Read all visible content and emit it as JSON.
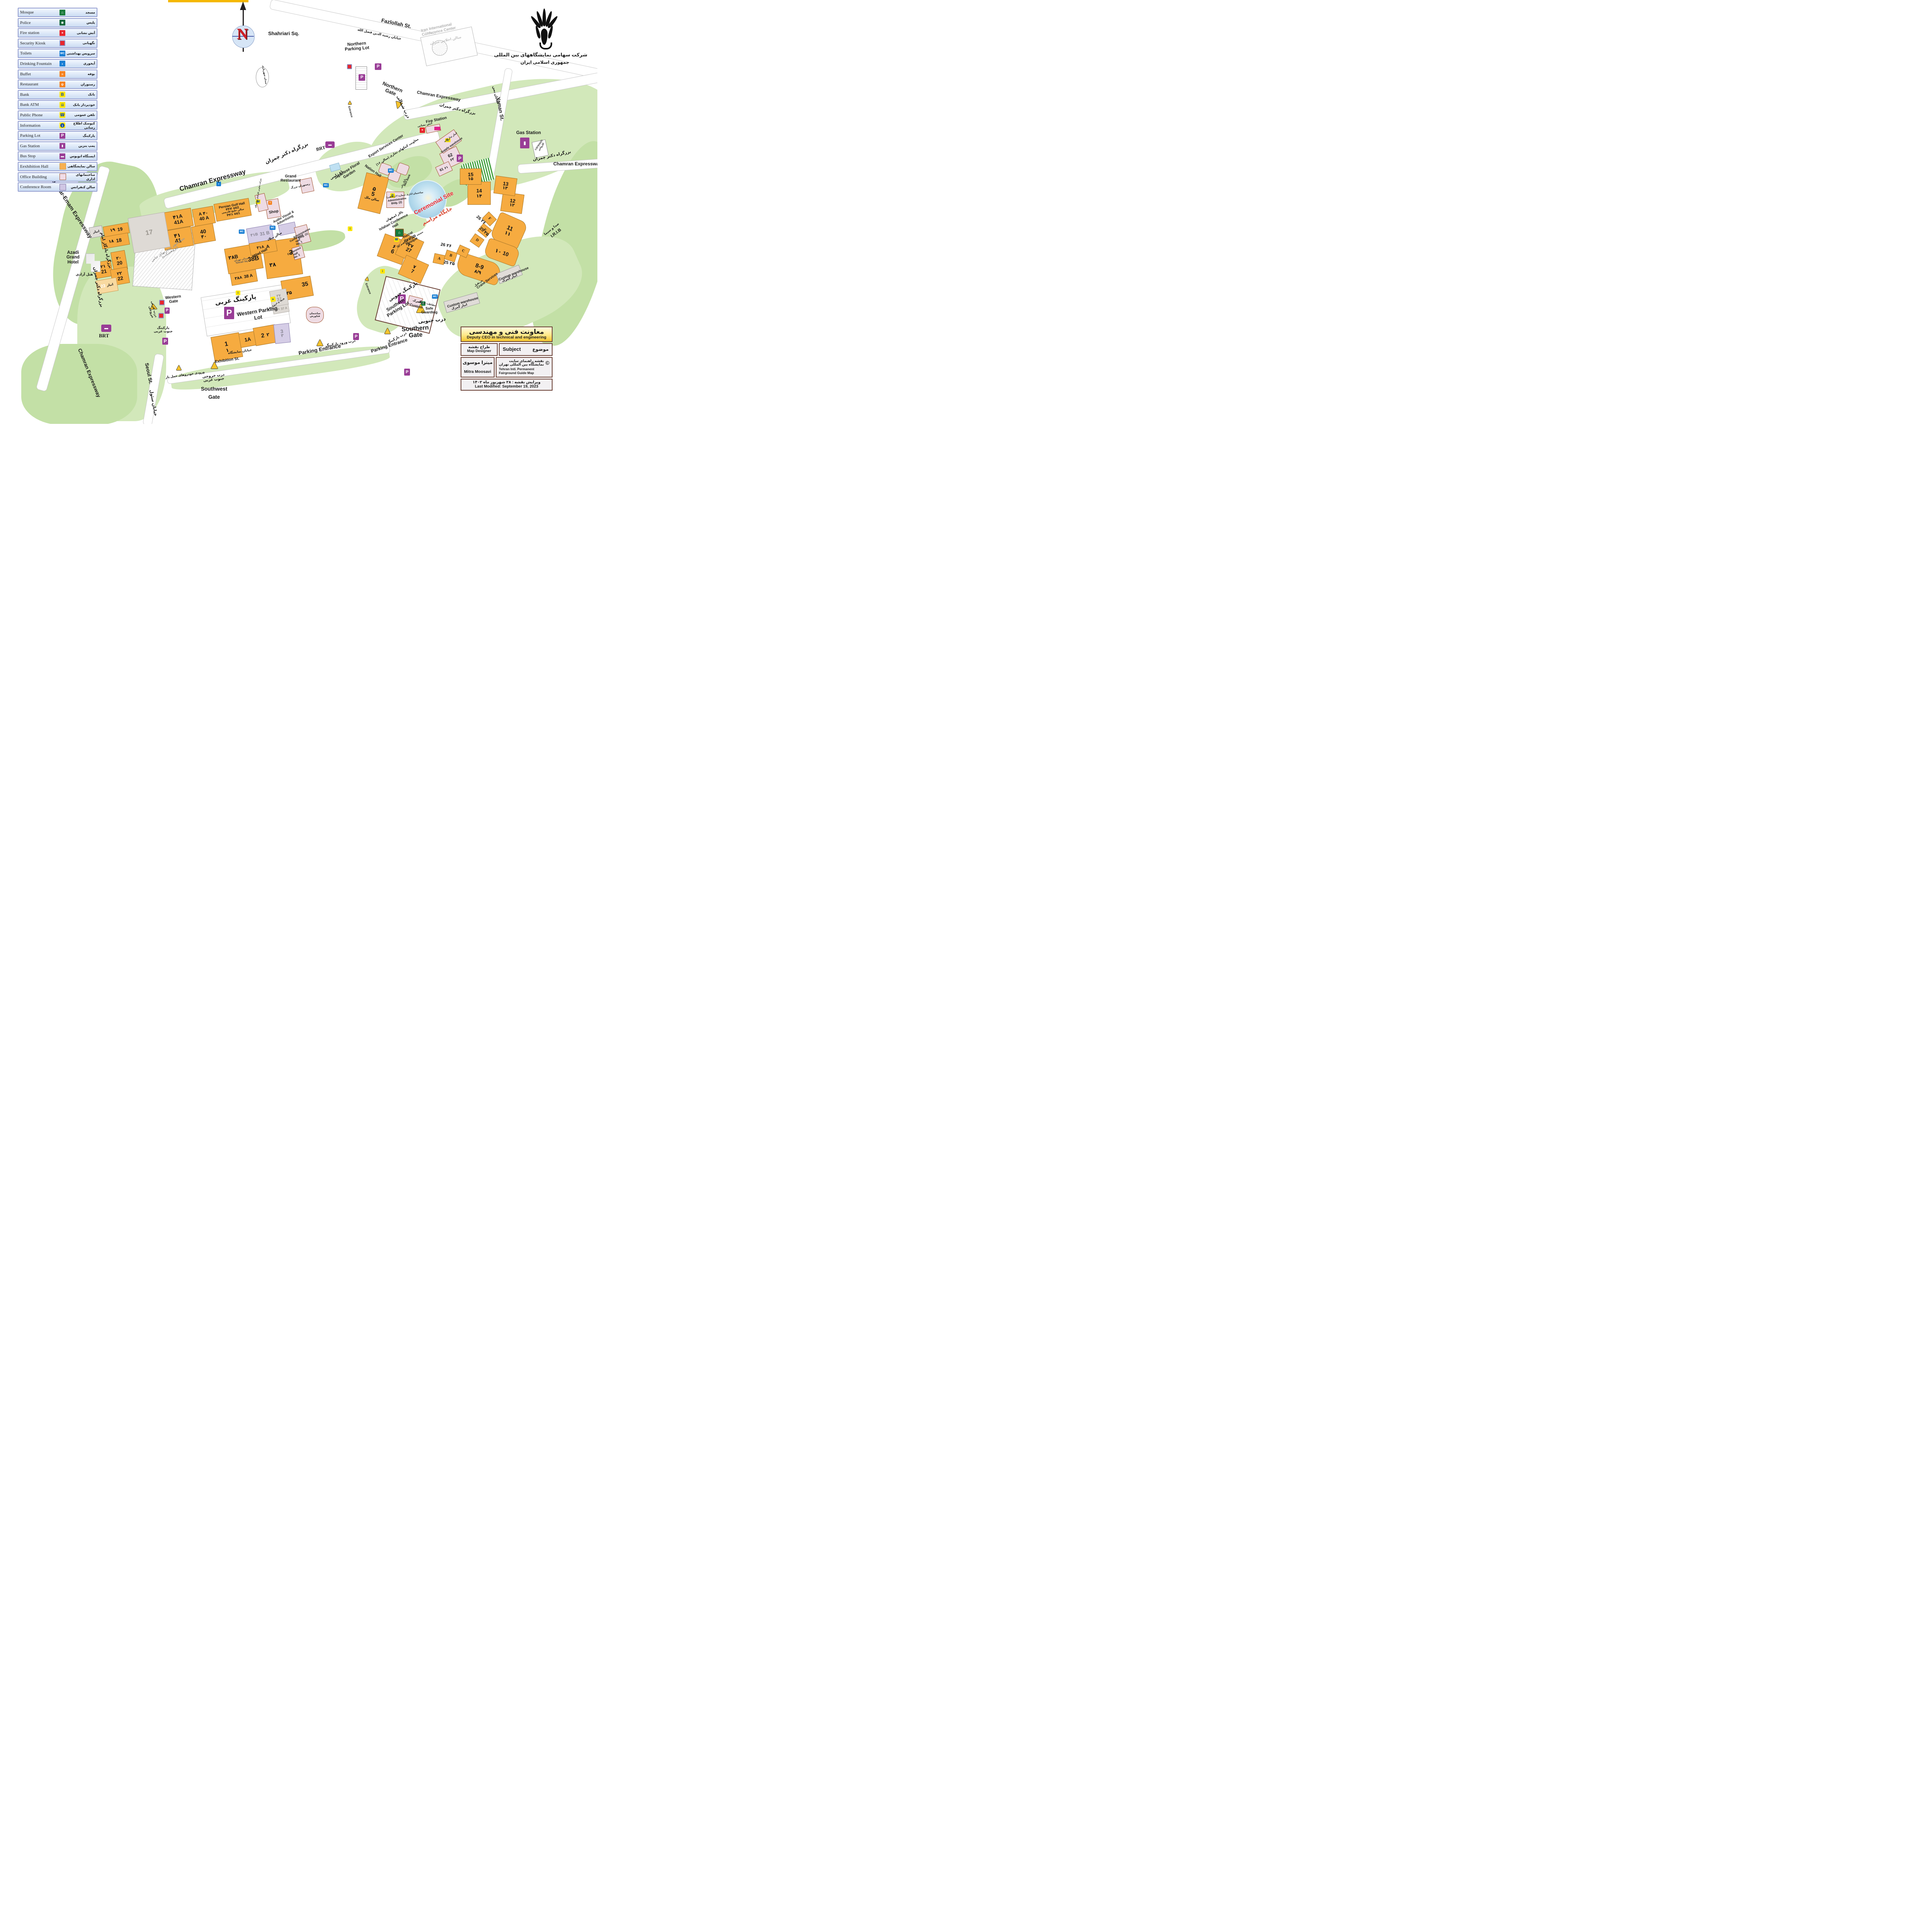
{
  "brand": {
    "company_fa_line1": "شرکت سهامی نمایشگاههای بین المللی",
    "company_fa_line2": "جمهوری اسلامی ایران",
    "compass_n": "N"
  },
  "legend": {
    "items": [
      {
        "en": "Mosque",
        "fa": "مسجد",
        "glyph": "⌂"
      },
      {
        "en": "Police",
        "fa": "پلیس",
        "glyph": "◉"
      },
      {
        "en": "Fire station",
        "fa": "آتش نشانی",
        "glyph": "✶"
      },
      {
        "en": "Security Kiosk",
        "fa": "نگهبانی",
        "glyph": ""
      },
      {
        "en": "Toilets",
        "fa": "سرویس بهداشتی",
        "glyph": "WC"
      },
      {
        "en": "Drinking Fountain",
        "fa": "آبخوری",
        "glyph": "◗"
      },
      {
        "en": "Buffet",
        "fa": "بوفه",
        "glyph": "≡"
      },
      {
        "en": "Restaurant",
        "fa": "رستوران",
        "glyph": "ψ"
      },
      {
        "en": "Bank",
        "fa": "بانک",
        "glyph": "B"
      },
      {
        "en": "Bank ATM",
        "fa": "خودپرداز بانک",
        "glyph": "▤"
      },
      {
        "en": "Public Phone",
        "fa": "تلفن عمومی",
        "glyph": "☎"
      },
      {
        "en": "Information",
        "fa": "کیوسک اطلاع رسانی",
        "glyph": "i"
      },
      {
        "en": "Parking Lot",
        "fa": "پارکینگ",
        "glyph": "P"
      },
      {
        "en": "Gas Station",
        "fa": "پمپ بنزین",
        "glyph": "▮"
      },
      {
        "en": "Bus Stop",
        "fa": "ایستگاه اتوبوس",
        "glyph": "▬"
      },
      {
        "en": "Eexhibition Hall",
        "fa": "سالن نمایشگاهی",
        "glyph": ""
      },
      {
        "en": "Office Building",
        "fa": "ساختمانهای اداری",
        "glyph": ""
      },
      {
        "en": "Conference Room",
        "fa": "سالن کنفرانس",
        "glyph": ""
      }
    ]
  },
  "top": {
    "shahriari": {
      "en": "Shahriari Sq.",
      "fa": "میدان شهریاری"
    },
    "conf_center": {
      "en1": "Iran International",
      "en2": "Conference Center",
      "fa": "سالن اجلاس سران"
    },
    "northern_parking1": "Northern",
    "northern_parking2": "Parking Lot"
  },
  "roads": {
    "chamran": {
      "en": "Chamran Expressway",
      "fa": "بزرگراه دکتر چمران"
    },
    "yadegar": {
      "en": "Yadegar-Emam Expressway",
      "fa": "بزرگراه یادگار امام"
    },
    "seoul": {
      "en": "Seoul St.",
      "fa": "خیابان سئول"
    },
    "yaman": {
      "en": "Yaman St.",
      "fa": "خیابان یمن"
    },
    "exhibition": {
      "en": "Exhibition St.",
      "fa": "خیابان نمایشگاه"
    },
    "fazlollah": {
      "en": "Fazlollah St.",
      "fa": "خیابان رشید الدین فضل الله"
    },
    "irib": {
      "en": "I.R.I.B",
      "fa": "صدا و سیما"
    },
    "brt": "BRT"
  },
  "gates": {
    "northern": {
      "en1": "Northern",
      "en2": "Gate",
      "fa": "درب شمالی"
    },
    "southern": {
      "en1": "Southern",
      "en2": "Gate",
      "fa": "درب جنوبی"
    },
    "western": {
      "en1": "Western",
      "en2": "Gate",
      "fa1": "درب غربی",
      "fa2": "خروجی"
    },
    "southwest": {
      "en1": "Southwest",
      "en2": "Gate",
      "fa1": "درب خروجی",
      "fa2": "جنوب غربی"
    },
    "pe_south": {
      "en": "Parking Entrance",
      "fa": "درب پارکینگ"
    },
    "pe_west": {
      "en": "Parking Entrance",
      "fa": "درب ورود پارکینگ"
    },
    "cargo": {
      "fa": "ورودی خودروهای حمل بار"
    },
    "entrance": {
      "en": "Entrance"
    }
  },
  "parking": {
    "western": {
      "en": "Western Parking Lot",
      "fa": "پارکینگ غربی"
    },
    "southern": {
      "en1": "Southern",
      "en2": "Parking Lot",
      "fa": "پارکینگ جنوبی"
    },
    "sw": {
      "fa1": "پارکینگ",
      "fa2": "جنوب غربی"
    }
  },
  "halls": [
    {
      "en": "41A",
      "fa": "۴۱A"
    },
    {
      "en": "41",
      "fa": "۴۱"
    },
    {
      "en": "40 A",
      "fa": "۴۰ A"
    },
    {
      "en": "40",
      "fa": "۴۰"
    },
    {
      "en": "19",
      "fa": "۱۹"
    },
    {
      "en": "18",
      "fa": "۱۸"
    },
    {
      "en": "17",
      "fa": ""
    },
    {
      "en": "20",
      "fa": "۲۰"
    },
    {
      "en": "21",
      "fa": "۲۱"
    },
    {
      "en": "22",
      "fa": "۲۲"
    },
    {
      "en": "23",
      "fa": "انبار"
    },
    {
      "en": "38B",
      "fa": "۳۸B"
    },
    {
      "en": "38 A",
      "fa": "۳۸A"
    },
    {
      "en": "38",
      "fa": "۳۸"
    },
    {
      "en": "35",
      "fa": "۳۵"
    },
    {
      "en": "37",
      "fa": "۳۷"
    },
    {
      "en": "37 A",
      "fa": "۳۷A"
    },
    {
      "en": "1",
      "fa": "۱"
    },
    {
      "en": "1A",
      "fa": ""
    },
    {
      "en": "2",
      "fa": "۲"
    },
    {
      "en": "3",
      "fa": "۳"
    },
    {
      "en": "5",
      "fa": "۵"
    },
    {
      "en": "6",
      "fa": "۶"
    },
    {
      "en": "27",
      "fa": "۲۷"
    },
    {
      "en": "7",
      "fa": "۷"
    },
    {
      "en": "8-9",
      "fa": "۸/۹"
    },
    {
      "en": "10",
      "fa": "۱۰"
    },
    {
      "en": "11",
      "fa": "۱۱"
    },
    {
      "en": "12",
      "fa": "۱۲"
    },
    {
      "en": "13",
      "fa": "۱۳"
    },
    {
      "en": "14",
      "fa": "۱۴"
    },
    {
      "en": "15",
      "fa": "۱۵"
    },
    {
      "en": "62",
      "fa": "۶۲"
    },
    {
      "en": "61",
      "fa": "۶۱"
    },
    {
      "en": "A"
    },
    {
      "en": "B"
    },
    {
      "en": "C"
    },
    {
      "en": "D"
    },
    {
      "en": "E"
    },
    {
      "en": "F"
    },
    {
      "en": "31 B",
      "fa": "۳۱B"
    },
    {
      "en": "A",
      "fa": "۳۱A"
    },
    {
      "en": "44/2",
      "fa": "۴۴/۲"
    },
    {
      "en": "44/1",
      "fa": "۴۴/۱"
    }
  ],
  "arc_labels": {
    "l25": {
      "en": "25",
      "fa": "۲۵"
    },
    "l26": {
      "en": "26",
      "fa": "۲۶"
    }
  },
  "facilities": {
    "persian_gulf": {
      "en1": "Persian Gulf",
      "en2": "Hall",
      "fa": "سالن خلیج فارسی"
    },
    "milad": {
      "en": "Milad Hall",
      "fa": "سالن میلاد"
    },
    "nation": {
      "en": "Nation Hall",
      "fa": "سالن ملل"
    },
    "shop": {
      "en": "Shop"
    },
    "coop": {
      "fa": "شرکت تعاونی کارکنان نمایشگاه"
    },
    "grand_rest": {
      "en1": "Grand",
      "en2": "Restaurant",
      "fa": "رستوران بزرگ"
    },
    "jfg": {
      "en1": "Japanese Floral",
      "en2": "Garden",
      "fa": "باغ ژاپنی"
    },
    "export": {
      "en": "Export Services Center",
      "fa": "معاونت کمکهای تجاری (سالن ۱۶)"
    },
    "admin2": {
      "en": "Administrative Bldg. (2)",
      "fa": "ساختمان اداری شماره ۲ (رفاهی)"
    },
    "admin1": {
      "en": "Administrative Bldg. (1)"
    },
    "meli": {
      "en": "Meli Bank",
      "fa": "بانک ملی"
    },
    "isfahan": {
      "en": "Isfahan Conference Hall",
      "fa": "تالار اصفهان"
    },
    "mosque": {
      "en1": "Hazrat",
      "en2": "Ibrahim",
      "en3": "Mosque",
      "fa": "مسجد حضرت ابراهیم (ع)"
    },
    "audio": {
      "en1": "Audio Visual &",
      "en2": "Advertising"
    },
    "conf1": {
      "en1": "Conference",
      "en2": "Hall",
      "en3": "No. 1"
    },
    "conf2": {
      "en1": "Conference",
      "en2": "Hall",
      "en3": "No. 2"
    },
    "tehran_sq": {
      "en": "Tehran Sq.",
      "fa": "میدان تهران"
    },
    "fire": {
      "en": "Fire Station",
      "fa": "آتش نشانی"
    },
    "supply": {
      "en": "Supply warehouse",
      "fa": "انبار تدارکات"
    },
    "gas": {
      "en": "Gas Station"
    },
    "carwash": {
      "en": "carwash",
      "fa": "کارواش"
    },
    "custom": {
      "en": "Custom",
      "fa": "گمرک"
    },
    "safe": {
      "en1": "Safe",
      "en2": "Guarding",
      "fa": "حفاظت فیزیکی"
    },
    "custom_wh": {
      "en": "Custom warehouse",
      "fa": "انبار گمرک"
    },
    "crane": {
      "en": "Crane Services",
      "fa": "جرثقیل"
    },
    "ceremonial": {
      "en": "Ceremonial Site",
      "fa": "جایگاه مراسم"
    },
    "azadi": {
      "en1": "Azadi",
      "en2": "Grand",
      "en3": "Hotel",
      "fa": "هتل آزادی"
    },
    "research": {
      "fa1": "بنیاد امور بیماریهای خاص",
      "fa2": "(پژوهشکده)"
    },
    "fanavaresh": {
      "fa1": "ساختمان",
      "fa2": "فناورش"
    },
    "pedestrian": {
      "fa": "ورود و خروج پیاده"
    },
    "anbar": {
      "fa": "انبار"
    }
  },
  "info_box": {
    "title_fa": "معاونت فنی و مهندسی",
    "title_en": "Deputy CEO in technical and engineering",
    "designer_fa": "طراح نقشه",
    "designer_en": "Map Designer",
    "subject_en": "Subject",
    "subject_fa": "موضوع",
    "designer_name_fa": "میترا موسوی",
    "designer_name_en": "Mitra Moosavi",
    "copyright": "©",
    "subject_value_fa1": "نقشه راهنمای سایت",
    "subject_value_fa2": "نمایشگاه بین المللی تهران",
    "subject_value_en1": "Tehran Intl. Permanent Fairground",
    "subject_value_en2": "Guide Map",
    "modified_fa": "ویرایش نقشه : ۲۸ شهریور ماه ۱۴۰۲",
    "modified_en": "Last Modified: September 19, 2023"
  }
}
